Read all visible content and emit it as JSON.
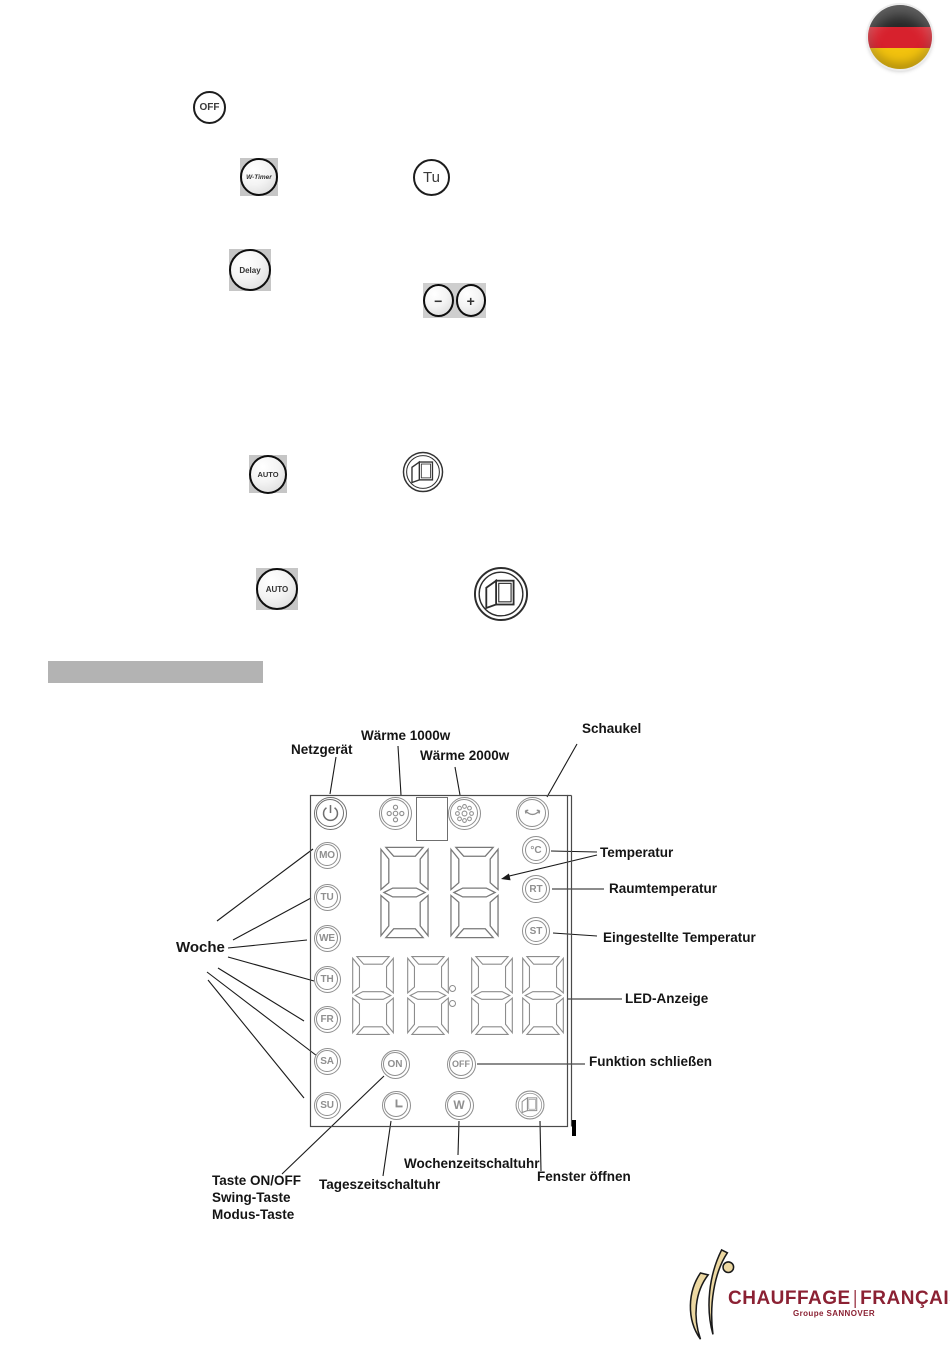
{
  "flag": {
    "name": "german-flag-icon"
  },
  "buttons": {
    "off": "OFF",
    "w_timer": "W-Timer",
    "tu": "Tu",
    "delay": "Delay",
    "minus": "−",
    "plus": "+",
    "auto": "AUTO"
  },
  "panel": {
    "weekdays": [
      "MO",
      "TU",
      "WE",
      "TH",
      "FR",
      "SA",
      "SU"
    ],
    "indicators": {
      "celsius": "°C",
      "room": "RT",
      "set": "ST"
    },
    "keys": {
      "on": "ON",
      "off": "OFF",
      "week": "W"
    }
  },
  "labels": {
    "netzgeraet": "Netzgerät",
    "waerme_1000": "Wärme 1000w",
    "waerme_2000": "Wärme 2000w",
    "schaukel": "Schaukel",
    "temperatur": "Temperatur",
    "raumtemperatur": "Raumtemperatur",
    "eingestellte_temperatur": "Eingestellte Temperatur",
    "led_anzeige": "LED-Anzeige",
    "funktion_schliessen": "Funktion schließen",
    "woche": "Woche",
    "taste_on_off": "Taste ON/OFF",
    "swing_taste": "Swing-Taste",
    "modus_taste": "Modus-Taste",
    "tageszeitschaltuhr": "Tageszeitschaltuhr",
    "wochenzeitschaltuhr": "Wochenzeitschaltuhr",
    "fenster_oeffnen": "Fenster öffnen"
  },
  "logo": {
    "brand_left": "CHAUFFAGE",
    "brand_right": "FRANÇAIS",
    "subtitle": "Groupe SANNOVER",
    "color": "#8b2133",
    "mark_color": "#ecd8a2"
  }
}
